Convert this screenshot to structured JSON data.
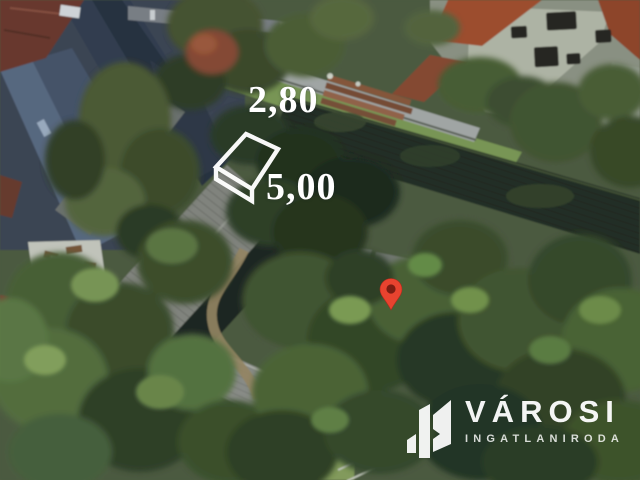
{
  "annotation": {
    "width_label": "2,80",
    "length_label": "5,00",
    "line_color": "#ffffff"
  },
  "marker": {
    "fill_color": "#e8432f",
    "dot_color": "#7c1d12"
  },
  "watermark": {
    "brand": "VÁROSI",
    "subtitle": "INGATLANIRODA",
    "color": "#ffffff"
  }
}
